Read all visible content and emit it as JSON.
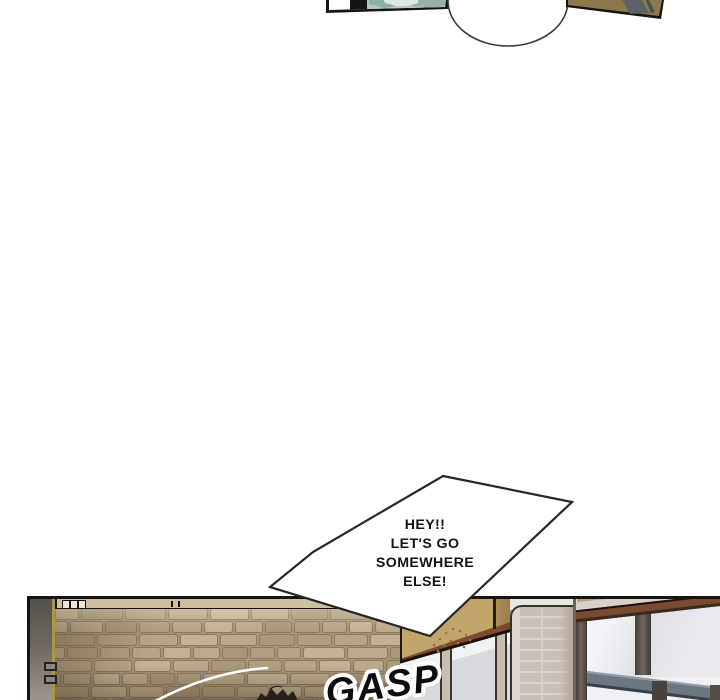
{
  "speech_bubble": {
    "lines": [
      "HEY!!",
      "LET'S GO",
      "SOMEWHERE",
      "ELSE!"
    ]
  },
  "sfx": {
    "text": "GASP"
  },
  "colors": {
    "page_background": "#ffffff",
    "ink_outline": "#17130f",
    "bubble_fill": "#ffffff",
    "stone_wall": "#b3a084",
    "stone_mortar": "#8a7860",
    "fascia_tan": "#c0a66a",
    "top_bar_tan": "#8d784c",
    "hair_teal": "#9bb7b0",
    "window_glass": "#e2e4e9",
    "steel_bar": "#6d7683",
    "tile_pillar": "#cbc0b7",
    "trim_brown": "#7c4a31"
  }
}
